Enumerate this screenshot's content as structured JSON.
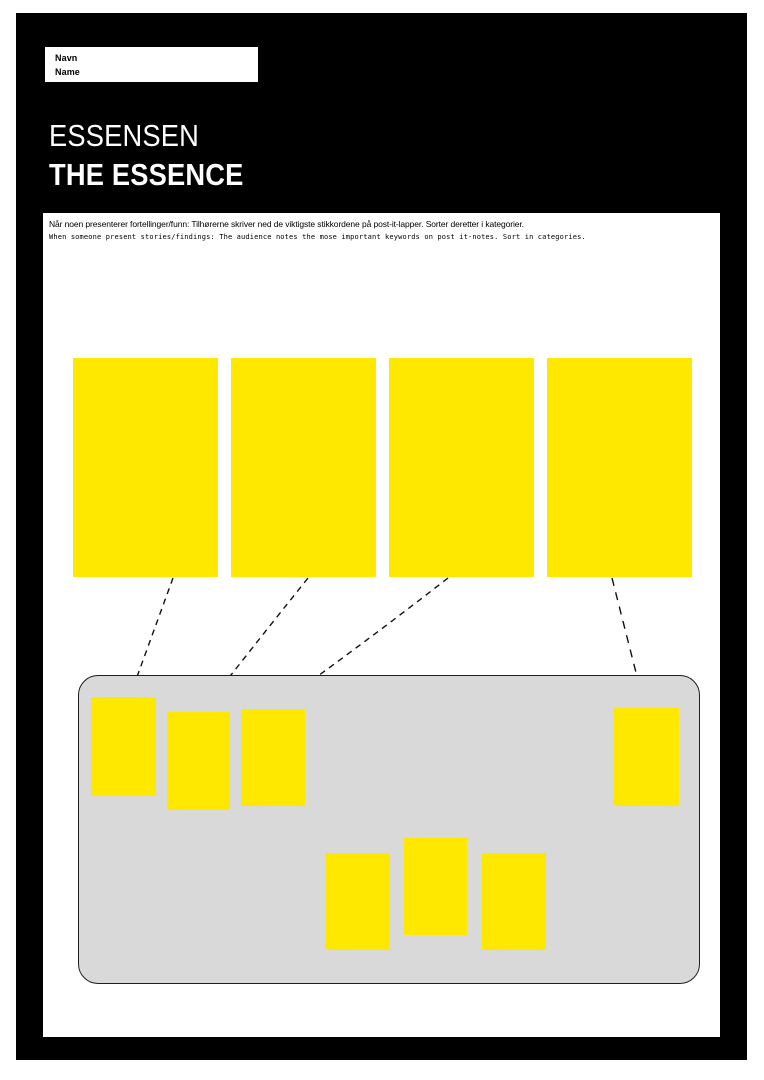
{
  "document": {
    "name_box": {
      "line1": "Navn",
      "line2": "Name"
    },
    "title": {
      "line1": "ESSENSEN",
      "line2": "THE ESSENCE"
    },
    "instructions": {
      "no": "Når noen presenterer fortellinger/funn: Tilhørerne skriver ned de viktigste stikkordene på post-it-lapper. Sorter deretter i kategorier.",
      "en": "When someone present stories/findings: The audience notes the mose important keywords on post it-notes. Sort in categories."
    }
  },
  "notes": {
    "large_placeholder_count": 4,
    "small_sorted_note_count": 7,
    "connector_count": 4
  },
  "colors": {
    "note_yellow": "#FFE800",
    "panel_gray": "#D9D9D9",
    "poster_black": "#000000",
    "page_white": "#FFFFFF"
  }
}
